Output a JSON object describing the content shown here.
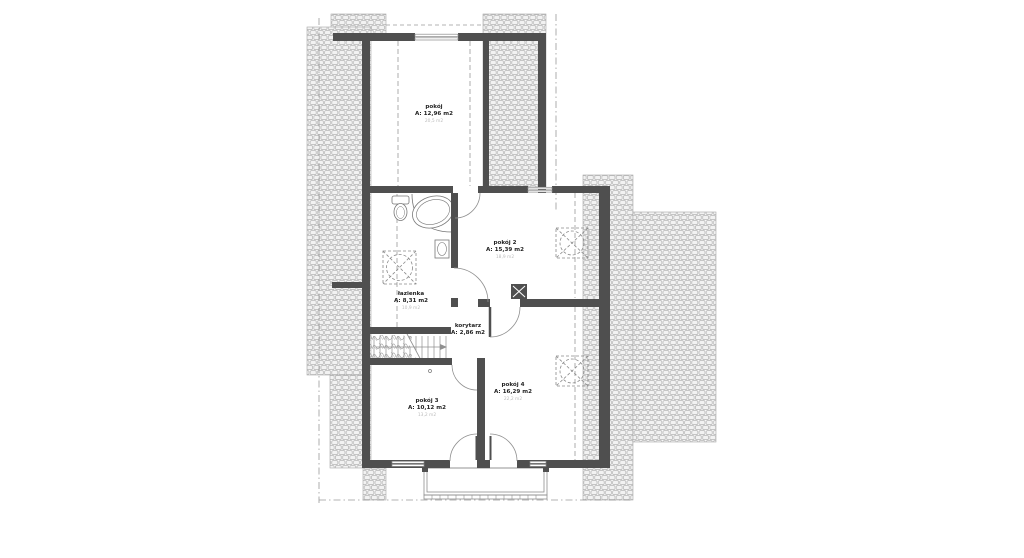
{
  "drawing": {
    "type": "architectural-floor-plan",
    "floor": "attic storey",
    "rooms": [
      {
        "id": "pokoj-1",
        "name": "pokój",
        "area": "A: 12,96 m2",
        "area_floor": "20,5 m2"
      },
      {
        "id": "pokoj-2",
        "name": "pokój 2",
        "area": "A: 15,39 m2",
        "area_floor": "18,9 m2"
      },
      {
        "id": "lazienka",
        "name": "łazienka",
        "area": "A: 8,31 m2",
        "area_floor": "10,9 m2"
      },
      {
        "id": "korytarz",
        "name": "korytarz",
        "area": "A: 2,86 m2",
        "area_floor": ""
      },
      {
        "id": "pokoj-3",
        "name": "pokój 3",
        "area": "A: 10,12 m2",
        "area_floor": "13,2 m2"
      },
      {
        "id": "pokoj-4",
        "name": "pokój 4",
        "area": "A: 16,29 m2",
        "area_floor": "22,2 m2"
      }
    ],
    "fixtures": [
      "toilet-icon",
      "bathtub-icon",
      "sink-icon",
      "chimney-icon",
      "stairs-icon",
      "roof-window-icon",
      "balcony",
      "door-swing"
    ],
    "colors": {
      "background": "#ffffff",
      "wall": "#4f4f4f",
      "hatch_line": "#b4b4b4",
      "thin_line": "#8f8f8f",
      "dash_line": "#9a9a9a",
      "text": "#1f1f1f",
      "text_secondary": "#bcbcbc"
    }
  }
}
